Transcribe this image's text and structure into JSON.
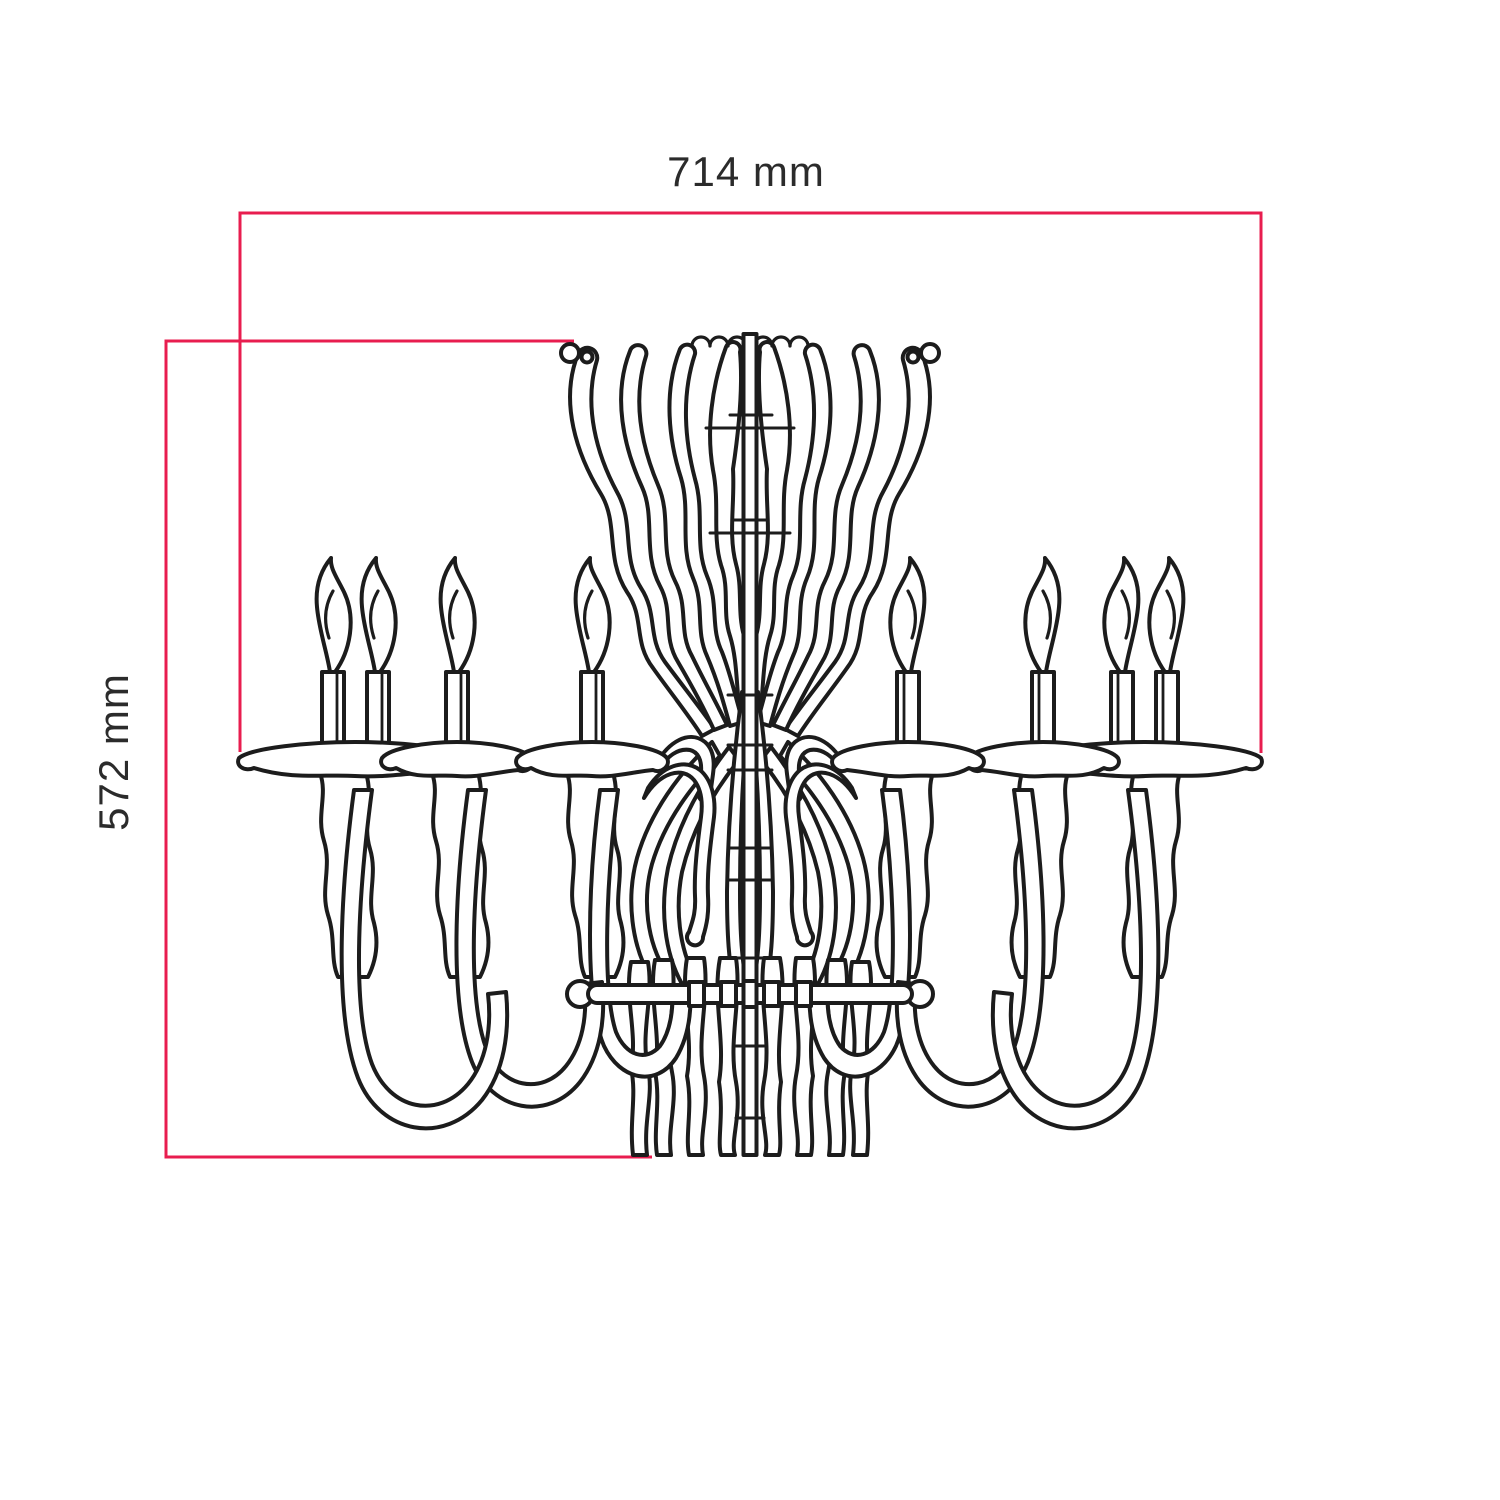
{
  "figure": {
    "type": "technical-dimension-drawing",
    "subject": "chandelier front elevation line drawing",
    "units": "mm"
  },
  "dimensions": {
    "width_label": "714 mm",
    "height_label": "572 mm"
  },
  "colors": {
    "dimension_line": "#e81d4f",
    "drawing_line": "#1c1c1c",
    "label_text": "#2b2b2b",
    "background": "#ffffff"
  }
}
